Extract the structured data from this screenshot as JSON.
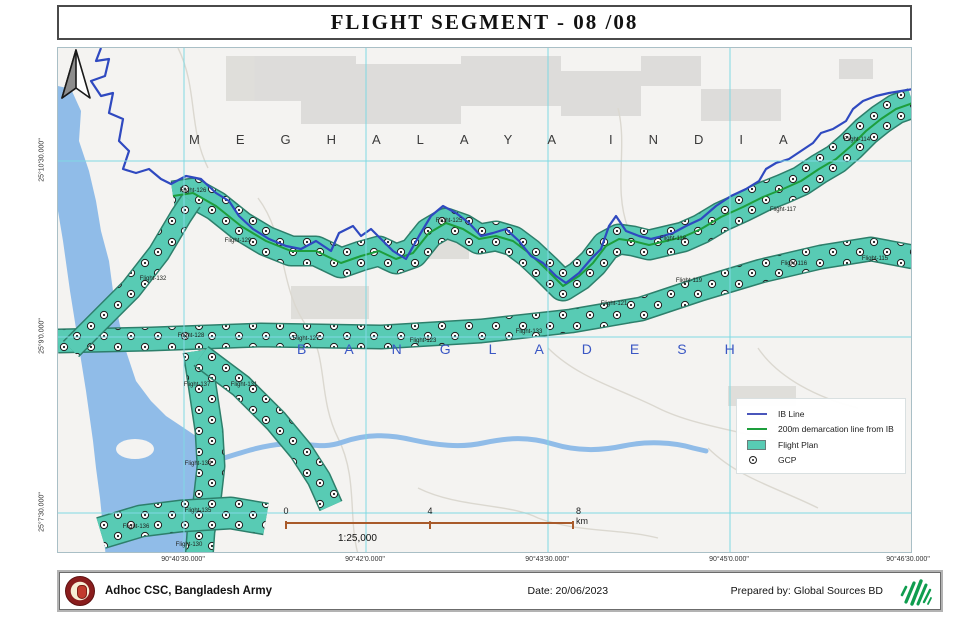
{
  "title": "FLIGHT SEGMENT - 08 /08",
  "map": {
    "region_labels": {
      "meghalaya": "MEGHALAYA",
      "india": "INDIA",
      "bangladesh": "BANGLADESH"
    },
    "flight_labels": [
      {
        "label": "Flight-126",
        "x": 135,
        "y": 143
      },
      {
        "label": "Flight-129",
        "x": 180,
        "y": 193
      },
      {
        "label": "Flight-132",
        "x": 95,
        "y": 231
      },
      {
        "label": "Flight-128",
        "x": 133,
        "y": 288
      },
      {
        "label": "Flight-127",
        "x": 248,
        "y": 291
      },
      {
        "label": "Flight-123",
        "x": 365,
        "y": 293
      },
      {
        "label": "Flight-133",
        "x": 471,
        "y": 284
      },
      {
        "label": "Flight-125",
        "x": 391,
        "y": 173
      },
      {
        "label": "Flight-121",
        "x": 556,
        "y": 256
      },
      {
        "label": "Flight-119",
        "x": 631,
        "y": 233
      },
      {
        "label": "Flight-118",
        "x": 615,
        "y": 191
      },
      {
        "label": "Flight-117",
        "x": 725,
        "y": 162
      },
      {
        "label": "Flight-114",
        "x": 799,
        "y": 92
      },
      {
        "label": "Flight-116",
        "x": 736,
        "y": 216
      },
      {
        "label": "Flight-115",
        "x": 817,
        "y": 211
      },
      {
        "label": "Flight-137",
        "x": 139,
        "y": 337
      },
      {
        "label": "Flight-131",
        "x": 186,
        "y": 337
      },
      {
        "label": "Flight-134",
        "x": 140,
        "y": 416
      },
      {
        "label": "Flight-135",
        "x": 140,
        "y": 463
      },
      {
        "label": "Flight-136",
        "x": 78,
        "y": 479
      },
      {
        "label": "Flight-130",
        "x": 131,
        "y": 497
      }
    ],
    "coordinates": {
      "longitude": [
        "90°40'30.000\"",
        "90°42'0.000\"",
        "90°43'30.000\"",
        "90°45'0.000\"",
        "90°46'30.000\""
      ],
      "latitude": [
        "25°10'30.000\"",
        "25°9'0.000\"",
        "25°7'30.000\""
      ]
    },
    "scale_bar": {
      "start": "0",
      "middle": "4",
      "end": "8 km",
      "ratio": "1:25,000"
    },
    "legend": {
      "items": [
        {
          "symbol": "ib-line",
          "label": "IB Line"
        },
        {
          "symbol": "demarcation-line",
          "label": "200m demarcation line from IB"
        },
        {
          "symbol": "flight-plan-fill",
          "label": "Flight Plan"
        },
        {
          "symbol": "gcp-marker",
          "label": "GCP"
        }
      ]
    }
  },
  "footer": {
    "organization": "Adhoc CSC, Bangladesh Army",
    "date": "Date: 20/06/2023",
    "prepared_by": "Prepared by: Global Sources BD"
  },
  "colors": {
    "flight_plan_fill": "#58cbb4",
    "ib_line": "#2f49c0",
    "demarcation_line": "#1d9e3c",
    "grid": "#7fd9e3",
    "water": "#90bce8",
    "scale_bar": "#a85a2a",
    "bangladesh_text": "#3a57c4"
  }
}
